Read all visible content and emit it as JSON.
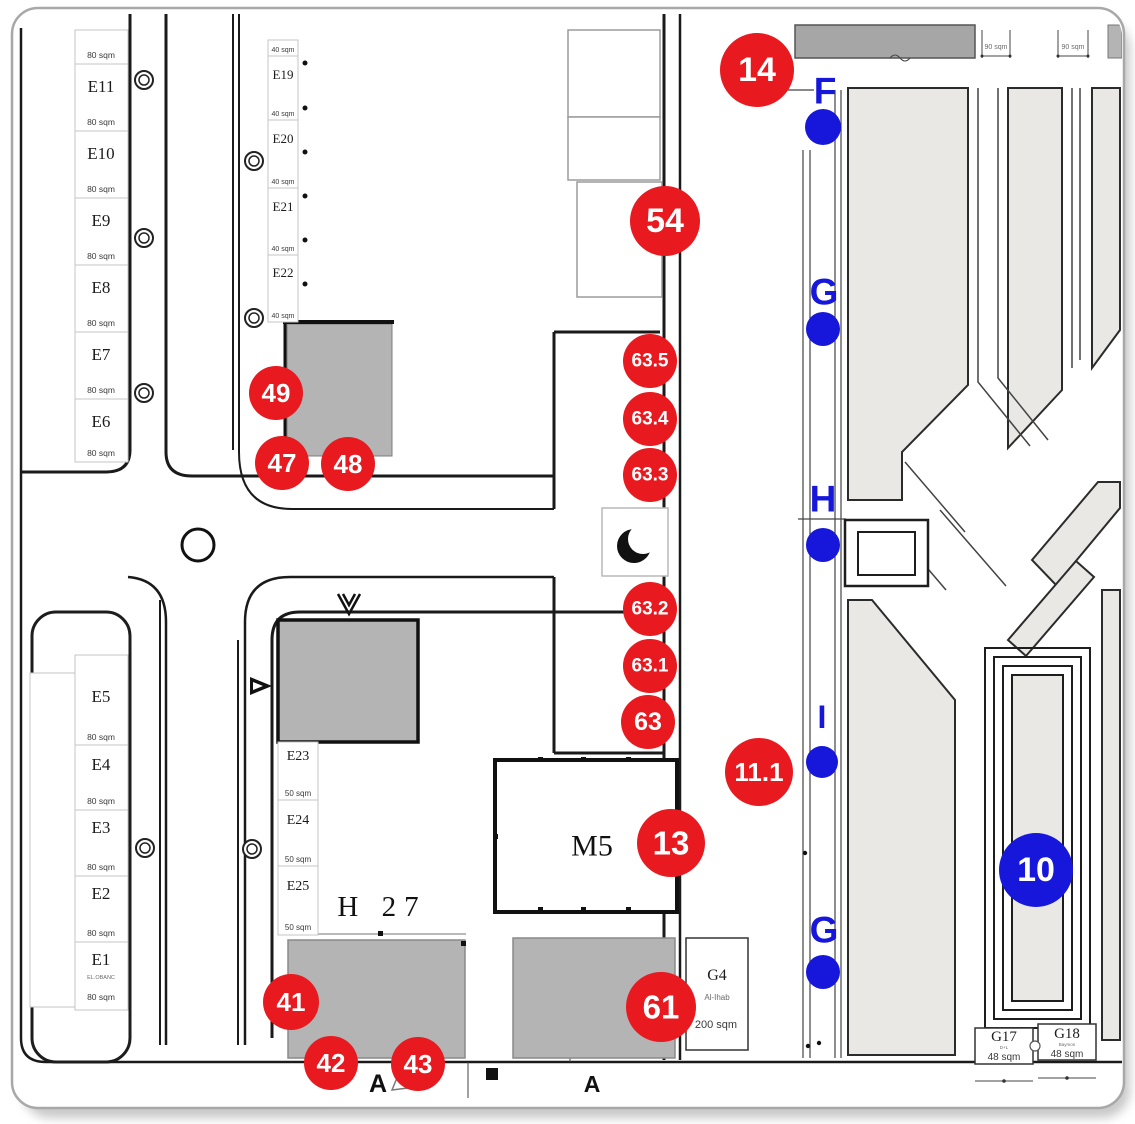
{
  "colors": {
    "red": "#e8191f",
    "blue": "#1717dc",
    "building_gray": "#b4b4b4",
    "building_dark": "#a6a6a6",
    "park_gray": "#eae8e5"
  },
  "left_upper_column": {
    "top_area": "80 sqm",
    "plots": [
      {
        "name": "E11",
        "area": "80 sqm"
      },
      {
        "name": "E10",
        "area": "80 sqm"
      },
      {
        "name": "E9",
        "area": "80 sqm"
      },
      {
        "name": "E8",
        "area": "80 sqm"
      },
      {
        "name": "E7",
        "area": "80 sqm"
      },
      {
        "name": "E6",
        "area": "80 sqm"
      }
    ]
  },
  "left_lower_column": {
    "plots": [
      {
        "name": "E5",
        "area": "80 sqm"
      },
      {
        "name": "E4",
        "area": "80 sqm"
      },
      {
        "name": "E3",
        "area": "80 sqm"
      },
      {
        "name": "E2",
        "area": "80 sqm"
      },
      {
        "name": "E1",
        "area": "80 sqm",
        "note": "EL.OBANC"
      }
    ]
  },
  "mid_upper_column": {
    "top_area": "40 sqm",
    "plots": [
      {
        "name": "E19",
        "area": "40 sqm"
      },
      {
        "name": "E20",
        "area": "40 sqm"
      },
      {
        "name": "E21",
        "area": "40 sqm"
      },
      {
        "name": "E22",
        "area": "40 sqm"
      }
    ]
  },
  "mid_lower_column": {
    "plots": [
      {
        "name": "E23",
        "area": "50 sqm"
      },
      {
        "name": "E24",
        "area": "50 sqm"
      },
      {
        "name": "E25",
        "area": "50 sqm"
      }
    ]
  },
  "labels": {
    "m5": "M5",
    "h27": "H 27",
    "dim_left": "90 sqm",
    "dim_right": "90 sqm"
  },
  "g4": {
    "name": "G4",
    "owner": "Al-Ihab",
    "area": "200 sqm"
  },
  "g17": {
    "name": "G17",
    "note": "D+L",
    "area": "48 sqm"
  },
  "g18": {
    "name": "G18",
    "note": "Baymon",
    "area": "48 sqm"
  },
  "red_markers": [
    {
      "label": "14"
    },
    {
      "label": "54"
    },
    {
      "label": "49"
    },
    {
      "label": "47"
    },
    {
      "label": "48"
    },
    {
      "label": "63.5"
    },
    {
      "label": "63.4"
    },
    {
      "label": "63.3"
    },
    {
      "label": "63.2"
    },
    {
      "label": "63.1"
    },
    {
      "label": "63"
    },
    {
      "label": "13"
    },
    {
      "label": "11.1"
    },
    {
      "label": "41"
    },
    {
      "label": "42"
    },
    {
      "label": "43"
    },
    {
      "label": "61"
    }
  ],
  "blue_markers": {
    "letters": [
      "F",
      "G",
      "H",
      "I",
      "G"
    ],
    "circle": "10"
  }
}
